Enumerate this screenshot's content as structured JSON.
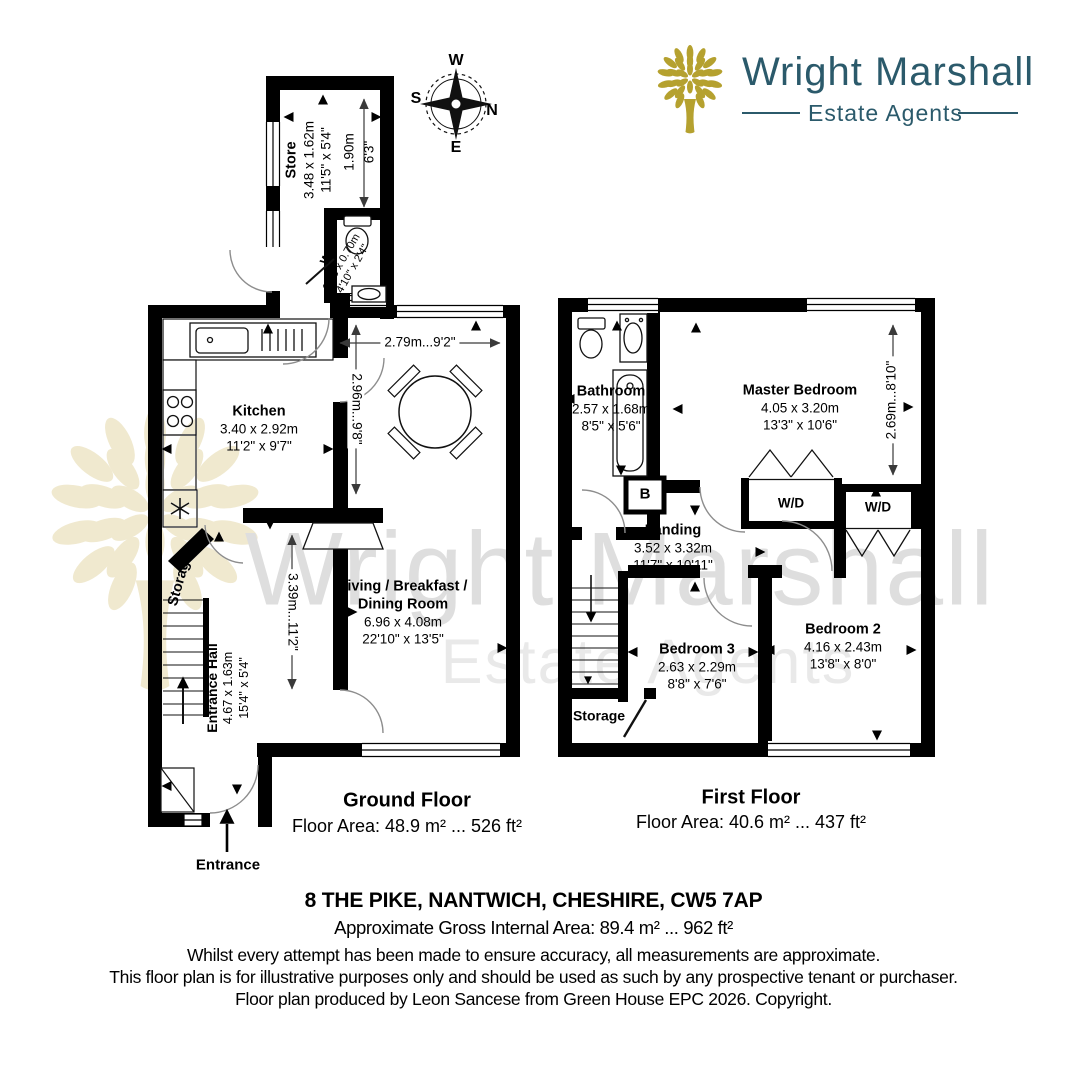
{
  "logo": {
    "brand": "Wright Marshall",
    "tagline": "Estate Agents",
    "brand_color": "#2b5a6b",
    "tree_color": "#b5a12f"
  },
  "compass": {
    "w": "W",
    "s": "S",
    "n": "N",
    "e": "E"
  },
  "gf": {
    "title": "Ground Floor",
    "area": "Floor Area: 48.9 m² ... 526 ft²",
    "entrance": "Entrance",
    "rooms": {
      "store": {
        "name": "Store",
        "metric": "3.48 x 1.62m",
        "imperial": "11'5\" x 5'4\""
      },
      "wc": {
        "name": "WC",
        "metric": "1.48 x 0.70m",
        "imperial": "4'10\" x 2'4\""
      },
      "kitchen": {
        "name": "Kitchen",
        "metric": "3.40 x 2.92m",
        "imperial": "11'2\" x 9'7\""
      },
      "living": {
        "name1": "Living / Breakfast /",
        "name2": "Dining Room",
        "metric": "6.96 x 4.08m",
        "imperial": "22'10\" x 13'5\""
      },
      "hall": {
        "name": "Entrance Hall",
        "metric": "4.67 x 1.63m",
        "imperial": "15'4\" x 5'4\""
      },
      "storage": {
        "name": "Storage"
      }
    },
    "dims": {
      "store_metric": "1.90m",
      "store_imperial": "6'3\"",
      "dining_w": "2.79m...9'2\"",
      "dining_h": "2.96m...9'8\"",
      "hall_h": "3.39m...11'2\""
    }
  },
  "ff": {
    "title": "First Floor",
    "area": "Floor Area: 40.6 m² ... 437 ft²",
    "rooms": {
      "bathroom": {
        "name": "Bathroom",
        "metric": "2.57 x 1.68m",
        "imperial": "8'5\" x 5'6\""
      },
      "master": {
        "name": "Master Bedroom",
        "metric": "4.05 x 3.20m",
        "imperial": "13'3\" x 10'6\""
      },
      "landing": {
        "name": "Landing",
        "metric": "3.52 x 3.32m",
        "imperial": "11'7\" x 10'11\""
      },
      "bed3": {
        "name": "Bedroom 3",
        "metric": "2.63 x 2.29m",
        "imperial": "8'8\" x 7'6\""
      },
      "bed2": {
        "name": "Bedroom 2",
        "metric": "4.16 x 2.43m",
        "imperial": "13'8\" x 8'0\""
      },
      "storage": {
        "name": "Storage"
      }
    },
    "closet1": "W/D",
    "closet2": "W/D",
    "boiler": "B",
    "dims": {
      "master_h": "2.69m...8'10\""
    }
  },
  "footer": {
    "address": "8 THE PIKE, NANTWICH, CHESHIRE, CW5 7AP",
    "gross": "Approximate Gross Internal Area: 89.4 m² ... 962 ft²",
    "disclaimer1": "Whilst every attempt has been made to ensure accuracy, all measurements are approximate.",
    "disclaimer2": "This floor plan is for illustrative purposes only and should be used as such by any prospective tenant or purchaser.",
    "credit": "Floor plan produced by Leon Sancese from Green House EPC 2026. Copyright."
  },
  "watermark": {
    "line1": "Wright Marshall",
    "line2": "Estate Agents"
  }
}
